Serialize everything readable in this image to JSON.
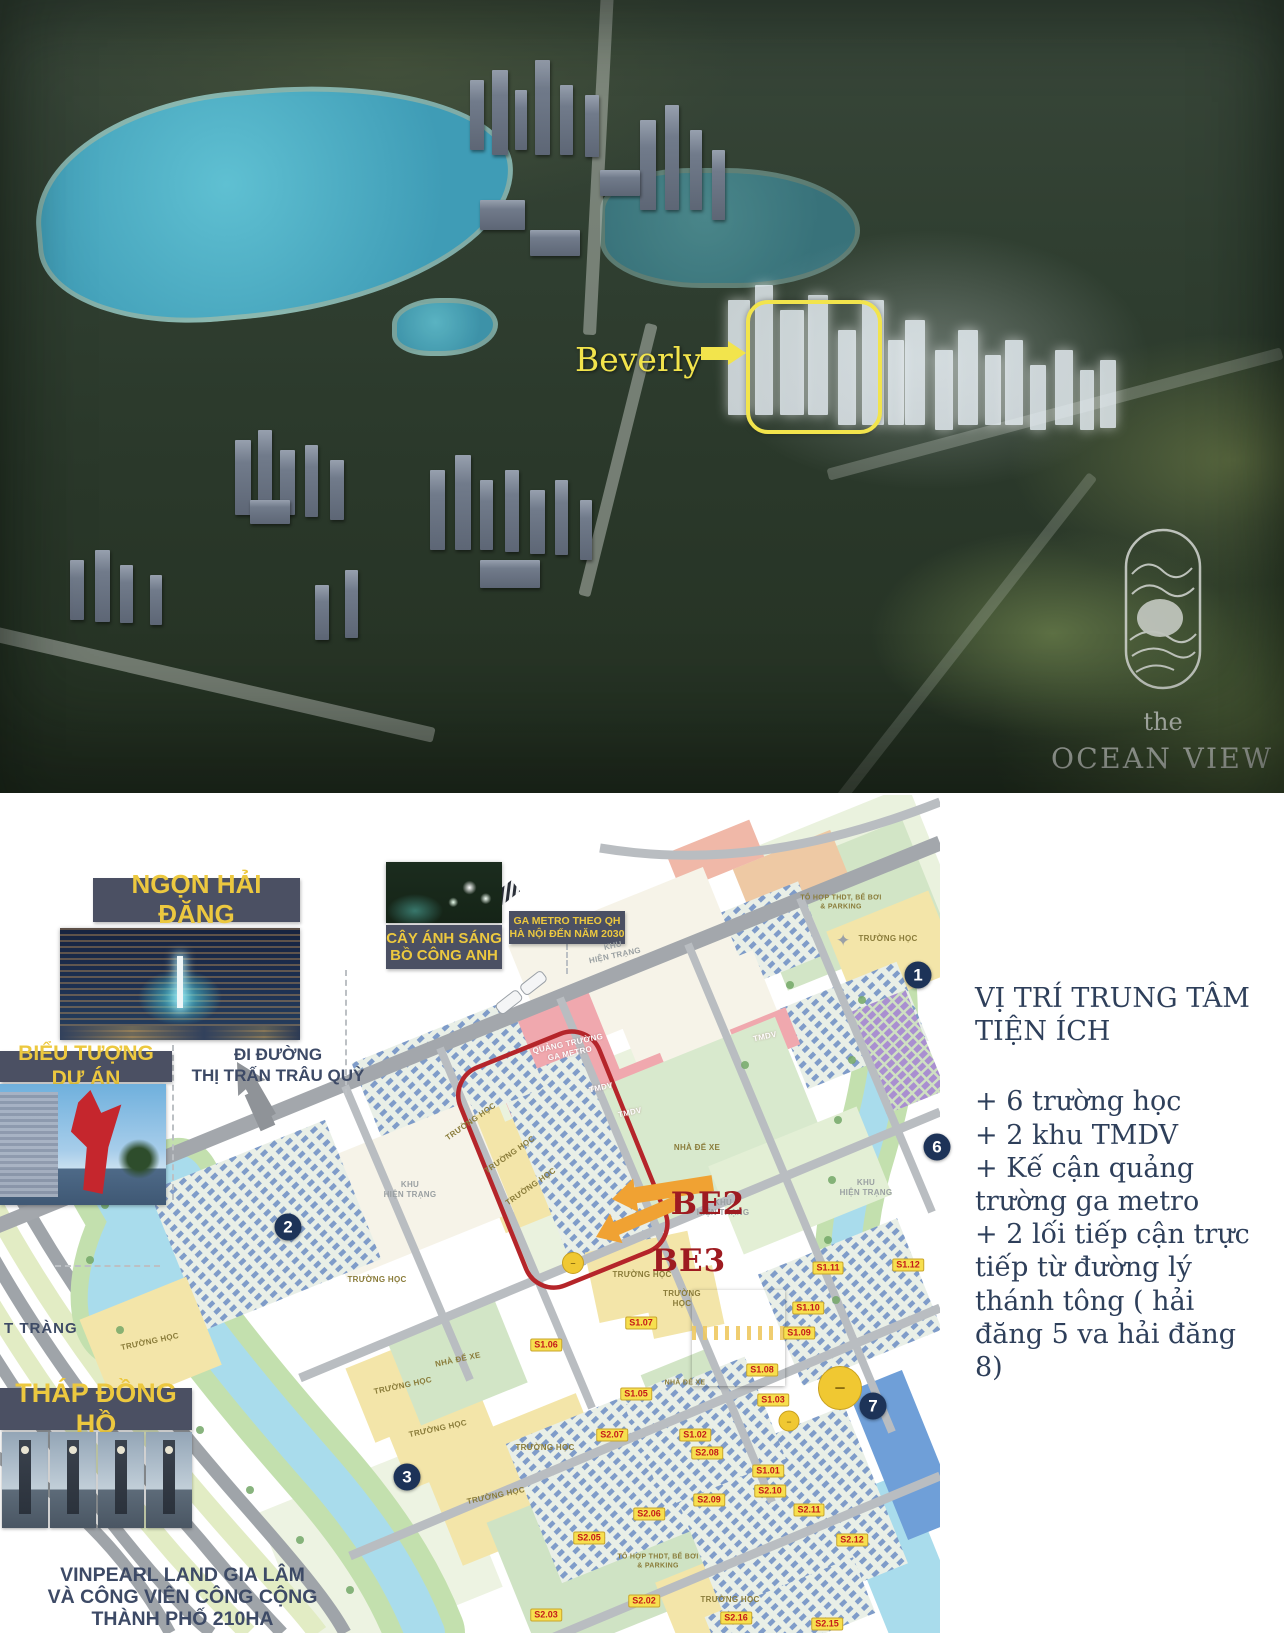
{
  "colors": {
    "chip_bg": "#4b5063",
    "chip_text": "#ecc83f",
    "annotation_navy": "#3d4a66",
    "be_red": "#9e1b21",
    "arrow_orange": "#f0a233",
    "boundary_red": "#b5252a",
    "badge_bg": "#f7df4e",
    "badge_text": "#c41a1a",
    "marker_navy": "#1d3358",
    "logo_gray": "#c9cdc7"
  },
  "aerial": {
    "beverly_label": "Beverly",
    "logo_the": "the",
    "logo_name": "OCEAN VIEW"
  },
  "chips": {
    "ngon_hai_dang": "NGỌN HẢI ĐĂNG",
    "cay_anh_sang": [
      "CÂY ÁNH SÁNG",
      "BỒ CÔNG ANH"
    ],
    "ga_metro": [
      "GA METRO THEO QH",
      "HÀ NỘI ĐẾN NĂM 2030"
    ],
    "bieu_tuong": "BIỂU TƯỢNG DỰ ÁN",
    "thap_dong_ho": "THÁP ĐỒNG HỒ"
  },
  "annotations": {
    "di_duong": [
      "ĐI ĐƯỜNG",
      "THỊ TRẤN TRÂU QUỲ"
    ],
    "bat_trang": "T TRÀNG",
    "vinpearl": [
      "VINPEARL LAND GIA LÂM",
      "VÀ CÔNG VIÊN CÔNG CỘNG",
      "THÀNH PHỐ 210HA"
    ],
    "be2": "BE2",
    "be3": "BE3"
  },
  "info_panel": {
    "title": [
      "VỊ TRÍ TRUNG TÂM",
      "TIỆN ÍCH"
    ],
    "bullets": [
      "+ 6 trường học",
      "+ 2 khu TMDV",
      "+ Kế cận quảng trường ga metro",
      "+ 2 lối tiếp cận trực tiếp từ đường lý thánh tông ( hải đăng 5 va hải đăng 8)"
    ]
  },
  "map": {
    "lot_badges": [
      {
        "t": "S1.01",
        "x": 768,
        "y": 1471
      },
      {
        "t": "S1.02",
        "x": 695,
        "y": 1435
      },
      {
        "t": "S1.03",
        "x": 773,
        "y": 1400
      },
      {
        "t": "S1.05",
        "x": 636,
        "y": 1394
      },
      {
        "t": "S1.06",
        "x": 546,
        "y": 1345
      },
      {
        "t": "S1.07",
        "x": 641,
        "y": 1323
      },
      {
        "t": "S1.08",
        "x": 762,
        "y": 1370
      },
      {
        "t": "S1.09",
        "x": 799,
        "y": 1333
      },
      {
        "t": "S1.10",
        "x": 808,
        "y": 1308
      },
      {
        "t": "S1.11",
        "x": 828,
        "y": 1268
      },
      {
        "t": "S1.12",
        "x": 908,
        "y": 1265
      },
      {
        "t": "S2.02",
        "x": 644,
        "y": 1601
      },
      {
        "t": "S2.03",
        "x": 546,
        "y": 1615
      },
      {
        "t": "S2.05",
        "x": 589,
        "y": 1538
      },
      {
        "t": "S2.06",
        "x": 649,
        "y": 1514
      },
      {
        "t": "S2.07",
        "x": 612,
        "y": 1435
      },
      {
        "t": "S2.08",
        "x": 707,
        "y": 1453
      },
      {
        "t": "S2.09",
        "x": 709,
        "y": 1500
      },
      {
        "t": "S2.10",
        "x": 770,
        "y": 1491
      },
      {
        "t": "S2.11",
        "x": 809,
        "y": 1510
      },
      {
        "t": "S2.12",
        "x": 852,
        "y": 1540
      },
      {
        "t": "S2.15",
        "x": 827,
        "y": 1624
      },
      {
        "t": "S2.16",
        "x": 736,
        "y": 1618
      }
    ],
    "numbered_markers": [
      {
        "n": "1",
        "x": 918,
        "y": 975
      },
      {
        "n": "2",
        "x": 288,
        "y": 1227
      },
      {
        "n": "3",
        "x": 407,
        "y": 1477
      },
      {
        "n": "6",
        "x": 937,
        "y": 1147
      },
      {
        "n": "7",
        "x": 873,
        "y": 1406
      }
    ],
    "yellow_dots": [
      {
        "x": 573,
        "y": 1263,
        "d": 20
      },
      {
        "x": 840,
        "y": 1388,
        "d": 42
      },
      {
        "x": 789,
        "y": 1421,
        "d": 19
      }
    ],
    "area_labels": [
      {
        "t": "QUẢNG TRƯỜNG\nGA METRO",
        "x": 569,
        "y": 1049,
        "r": -12,
        "c": "wht",
        "s": 8
      },
      {
        "t": "TMDV",
        "x": 601,
        "y": 1088,
        "r": -12,
        "c": "wht",
        "s": 8
      },
      {
        "t": "TMDV",
        "x": 630,
        "y": 1113,
        "r": -12,
        "c": "wht",
        "s": 8
      },
      {
        "t": "TMDV",
        "x": 765,
        "y": 1037,
        "r": -12,
        "c": "wht",
        "s": 8
      },
      {
        "t": "KHU\nHIỆN TRẠNG",
        "x": 614,
        "y": 951,
        "r": -12,
        "c": "gry",
        "s": 8
      },
      {
        "t": "KHU\nHIỆN TRẠNG",
        "x": 410,
        "y": 1190,
        "r": 0,
        "c": "gry",
        "s": 8
      },
      {
        "t": "KHU\nHIỆN TRẠNG",
        "x": 866,
        "y": 1188,
        "r": 0,
        "c": "gry",
        "s": 8
      },
      {
        "t": "KHU\nHIỆN TRẠNG",
        "x": 723,
        "y": 1208,
        "r": 0,
        "c": "gry",
        "s": 8
      },
      {
        "t": "TRƯỜNG HỌC",
        "x": 471,
        "y": 1122,
        "r": -35,
        "c": "olv",
        "s": 8
      },
      {
        "t": "TRƯỜNG HỌC",
        "x": 510,
        "y": 1155,
        "r": -35,
        "c": "olv",
        "s": 8
      },
      {
        "t": "TRƯỜNG HỌC",
        "x": 531,
        "y": 1187,
        "r": -35,
        "c": "olv",
        "s": 8
      },
      {
        "t": "TRƯỜNG HỌC",
        "x": 888,
        "y": 939,
        "r": 0,
        "c": "olv",
        "s": 8
      },
      {
        "t": "TRƯỜNG HỌC",
        "x": 642,
        "y": 1275,
        "r": 0,
        "c": "olv",
        "s": 8
      },
      {
        "t": "TRƯỜNG\nHỌC",
        "x": 682,
        "y": 1299,
        "r": 0,
        "c": "olv",
        "s": 8
      },
      {
        "t": "TRƯỜNG HỌC",
        "x": 377,
        "y": 1280,
        "r": 0,
        "c": "olv",
        "s": 8
      },
      {
        "t": "TRƯỜNG HỌC",
        "x": 150,
        "y": 1342,
        "r": -12,
        "c": "olv",
        "s": 8
      },
      {
        "t": "TRƯỜNG HỌC",
        "x": 403,
        "y": 1386,
        "r": -12,
        "c": "olv",
        "s": 8
      },
      {
        "t": "TRƯỜNG HỌC",
        "x": 438,
        "y": 1429,
        "r": -12,
        "c": "olv",
        "s": 8
      },
      {
        "t": "TRƯỜNG HỌC",
        "x": 545,
        "y": 1448,
        "r": 0,
        "c": "olv",
        "s": 8
      },
      {
        "t": "TRƯỜNG HỌC",
        "x": 496,
        "y": 1496,
        "r": -12,
        "c": "olv",
        "s": 8
      },
      {
        "t": "TRƯỜNG HỌC",
        "x": 730,
        "y": 1600,
        "r": 0,
        "c": "olv",
        "s": 8
      },
      {
        "t": "NHÀ ĐỂ XE",
        "x": 697,
        "y": 1148,
        "r": 0,
        "c": "olv",
        "s": 8
      },
      {
        "t": "NHÀ ĐỂ XE",
        "x": 458,
        "y": 1360,
        "r": -12,
        "c": "olv",
        "s": 8
      },
      {
        "t": "NHÀ ĐỂ XE",
        "x": 685,
        "y": 1384,
        "r": 0,
        "c": "olv",
        "s": 7
      },
      {
        "t": "TỔ HỢP THDT, BỂ BƠI\n& PARKING",
        "x": 841,
        "y": 903,
        "r": 0,
        "c": "olv",
        "s": 7
      },
      {
        "t": "TỔ HỢP THDT, BỂ BƠI\n& PARKING",
        "x": 658,
        "y": 1562,
        "r": 0,
        "c": "olv",
        "s": 7
      }
    ]
  }
}
